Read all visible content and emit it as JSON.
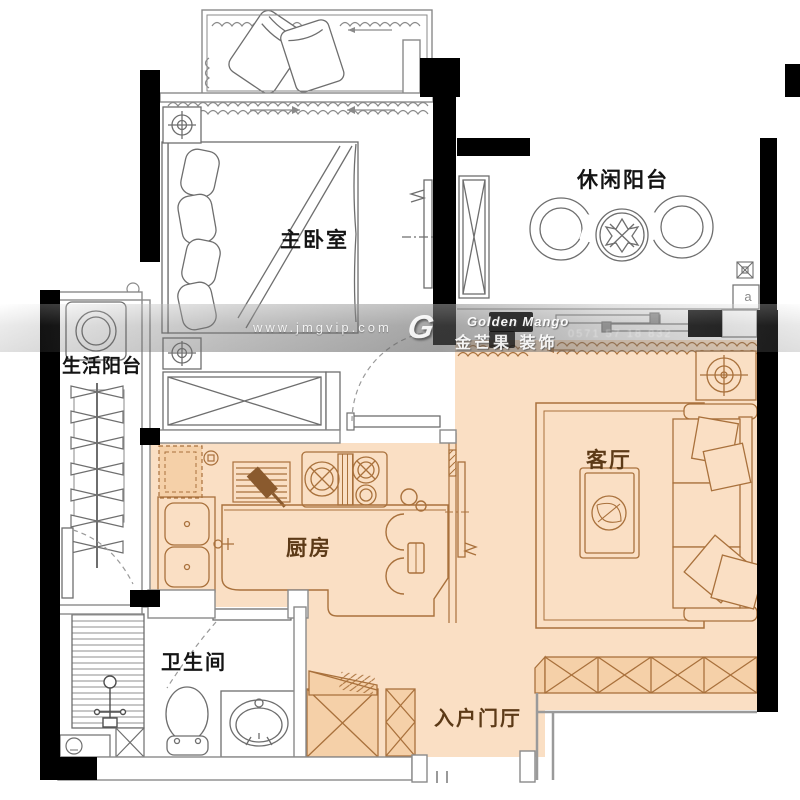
{
  "rooms": {
    "master_bedroom": "主卧室",
    "leisure_balcony": "休闲阳台",
    "utility_balcony": "生活阳台",
    "kitchen": "厨房",
    "living_room": "客厅",
    "bathroom": "卫生间",
    "entry_hall": "入户门厅"
  },
  "watermark": {
    "url": "www.jmgvip.com",
    "logo_letter": "G",
    "brand_en": "Golden Mango",
    "brand_cn": "金芒果 装饰",
    "phone": "0571 57 18 832"
  },
  "symbols": {
    "balcony_vent_label": "a"
  },
  "colors": {
    "highlight_fill": "#fadfc4",
    "highlight_dark_fill": "#f5d0a8",
    "plan_line_gray": "#6e6e6e",
    "plan_line_brown": "#a9713c",
    "wall_black": "#000000",
    "label_black": "#141414",
    "label_brown": "#5c3a17"
  }
}
